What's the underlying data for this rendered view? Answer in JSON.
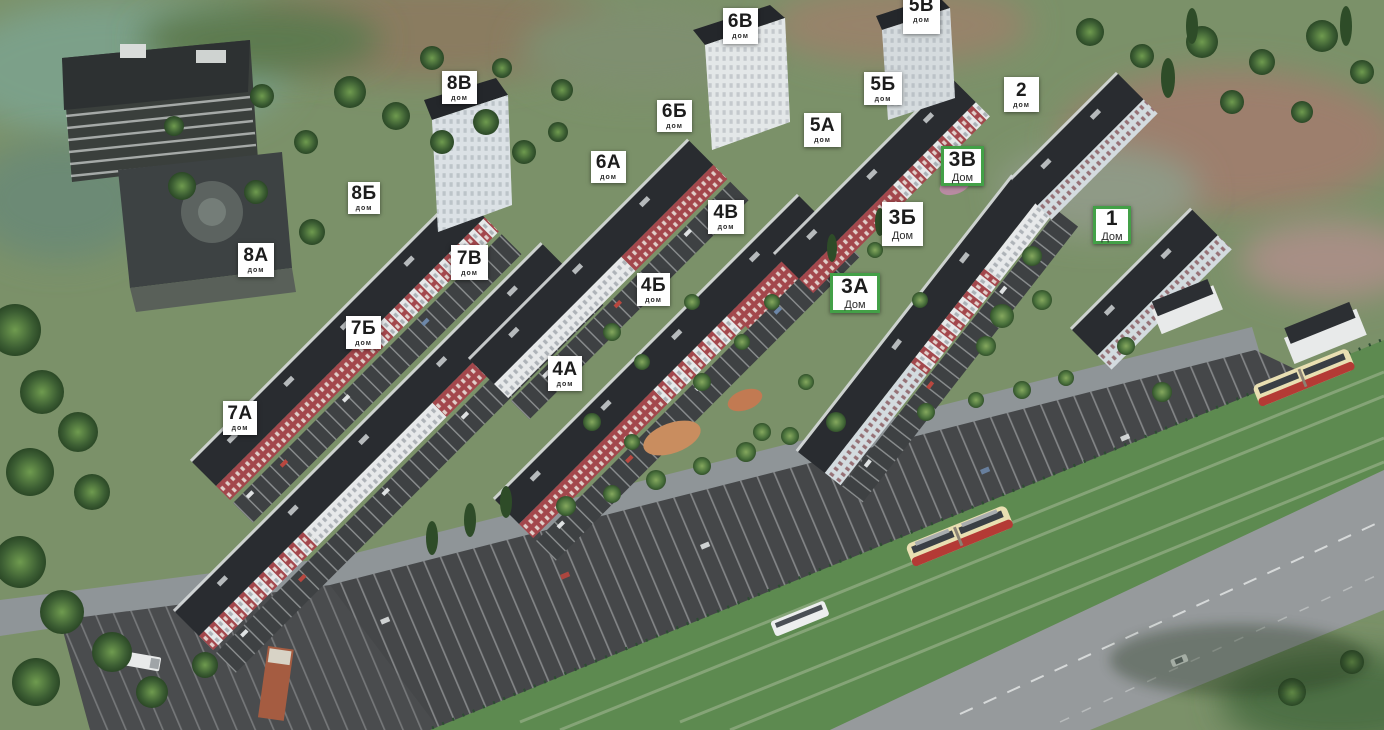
{
  "map": {
    "type": "residential-complex-masterplan-3d",
    "markers": [
      {
        "label": "6В",
        "sublabel": "дом",
        "variant": "default",
        "x": 723,
        "y": 8,
        "w": 35,
        "h": 36
      },
      {
        "label": "5В",
        "sublabel": "дом",
        "variant": "default",
        "x": 903,
        "y": -14,
        "w": 37,
        "h": 48
      },
      {
        "label": "8В",
        "sublabel": "дом",
        "variant": "default",
        "x": 442,
        "y": 71,
        "w": 35,
        "h": 33
      },
      {
        "label": "5Б",
        "sublabel": "дом",
        "variant": "default",
        "x": 864,
        "y": 72,
        "w": 38,
        "h": 33
      },
      {
        "label": "2",
        "sublabel": "дом",
        "variant": "default",
        "x": 1004,
        "y": 77,
        "w": 35,
        "h": 35
      },
      {
        "label": "6Б",
        "sublabel": "дом",
        "variant": "default",
        "x": 657,
        "y": 100,
        "w": 35,
        "h": 32
      },
      {
        "label": "5А",
        "sublabel": "дом",
        "variant": "default",
        "x": 804,
        "y": 113,
        "w": 37,
        "h": 34
      },
      {
        "label": "3В",
        "sublabel": "Дом",
        "variant": "green",
        "x": 941,
        "y": 146,
        "w": 43,
        "h": 40
      },
      {
        "label": "6А",
        "sublabel": "дом",
        "variant": "default",
        "x": 591,
        "y": 151,
        "w": 35,
        "h": 32
      },
      {
        "label": "8Б",
        "sublabel": "дом",
        "variant": "default",
        "x": 348,
        "y": 182,
        "w": 32,
        "h": 32
      },
      {
        "label": "4В",
        "sublabel": "дом",
        "variant": "default",
        "x": 708,
        "y": 200,
        "w": 36,
        "h": 34
      },
      {
        "label": "3Б",
        "sublabel": "Дом",
        "variant": "default",
        "x": 882,
        "y": 202,
        "w": 41,
        "h": 44
      },
      {
        "label": "1",
        "sublabel": "Дом",
        "variant": "green",
        "x": 1093,
        "y": 206,
        "w": 38,
        "h": 38
      },
      {
        "label": "8А",
        "sublabel": "дом",
        "variant": "default",
        "x": 238,
        "y": 243,
        "w": 36,
        "h": 34
      },
      {
        "label": "7В",
        "sublabel": "дом",
        "variant": "default",
        "x": 451,
        "y": 245,
        "w": 37,
        "h": 35
      },
      {
        "label": "4Б",
        "sublabel": "дом",
        "variant": "default",
        "x": 637,
        "y": 273,
        "w": 33,
        "h": 33
      },
      {
        "label": "3А",
        "sublabel": "Дом",
        "variant": "green",
        "x": 830,
        "y": 273,
        "w": 50,
        "h": 40
      },
      {
        "label": "7Б",
        "sublabel": "дом",
        "variant": "default",
        "x": 346,
        "y": 316,
        "w": 35,
        "h": 33
      },
      {
        "label": "4А",
        "sublabel": "дом",
        "variant": "default",
        "x": 548,
        "y": 356,
        "w": 34,
        "h": 35
      },
      {
        "label": "7А",
        "sublabel": "дом",
        "variant": "default",
        "x": 223,
        "y": 401,
        "w": 34,
        "h": 34
      }
    ],
    "colors": {
      "marker_bg": "#ffffff",
      "marker_text": "#1c1c1c",
      "marker_green_border": "#43a047",
      "roof": "#292c30",
      "facade_red": "#a3474c",
      "facade_white": "#e7e9ea",
      "grass": "#7b9169",
      "asphalt_dark": "#454749",
      "road_light": "#969a9c",
      "tram_body": "#e9dfb2",
      "tram_stripe": "#b43a35",
      "tram_lane": "#5d8a50"
    }
  }
}
